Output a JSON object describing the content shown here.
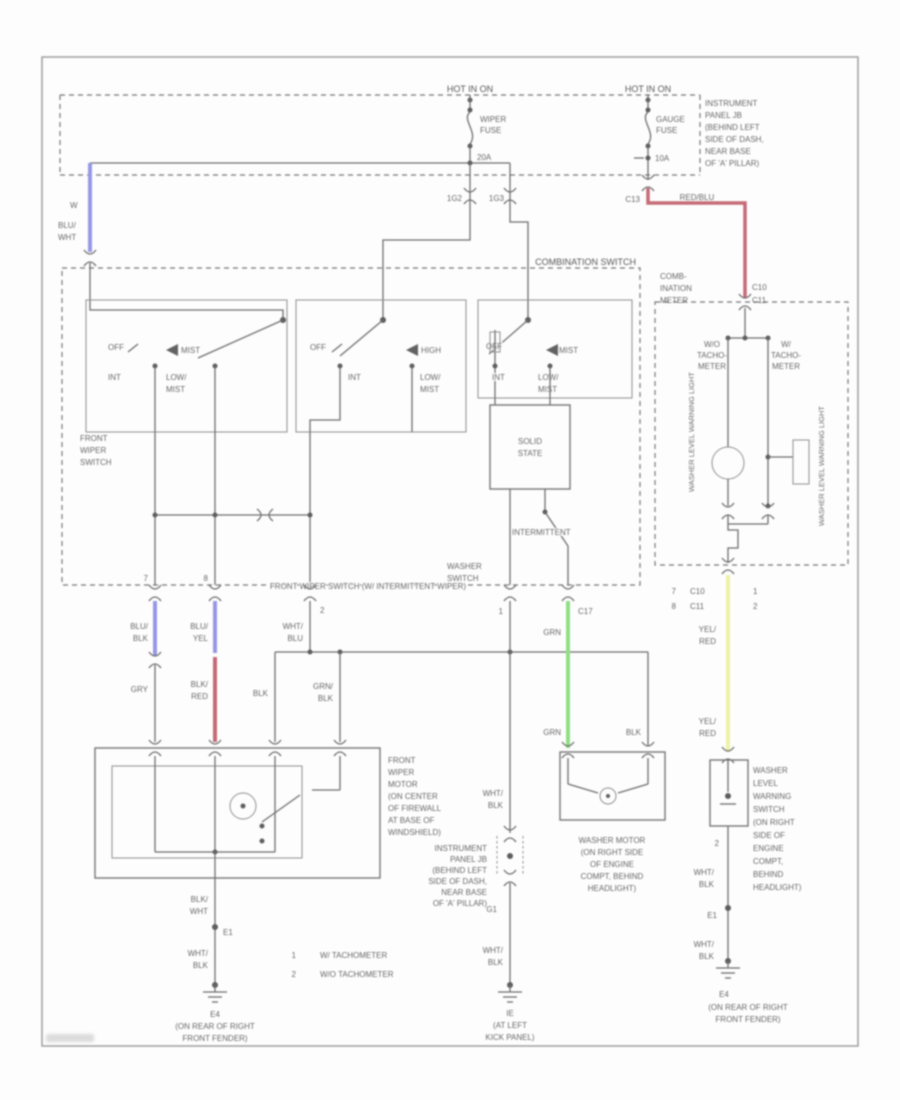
{
  "power": {
    "hot_left": "HOT IN ON",
    "hot_right": "HOT IN ON",
    "wiper_fuse_1": "WIPER",
    "wiper_fuse_2": "FUSE",
    "wiper_fuse_amps": "20A",
    "gauge_fuse_1": "GAUGE",
    "gauge_fuse_2": "FUSE",
    "gauge_fuse_amps": "10A",
    "conn_left_a": "1G2",
    "conn_left_b": "1G3",
    "conn_right": "C13",
    "red_wire_label": "RED/BLU",
    "jb_label": [
      "INSTRUMENT",
      "PANEL JB",
      "(BEHIND LEFT",
      "SIDE OF DASH,",
      "NEAR BASE",
      "OF 'A' PILLAR)"
    ]
  },
  "comb_switch": {
    "title": "COMBINATION SWITCH",
    "switch_name": [
      "FRONT",
      "WIPER",
      "SWITCH"
    ],
    "bottom_label": "FRONT WIPER SWITCH (W/ INTERMITTENT WIPER)",
    "solid_state": [
      "SOLID",
      "STATE"
    ],
    "intermittent": "INTERMITTENT",
    "washer_switch": [
      "WASHER",
      "SWITCH"
    ],
    "bank1": {
      "off": "OFF",
      "momentary": "MIST",
      "int": "INT",
      "low_1": "LOW/",
      "low_2": "MIST"
    },
    "bank2": {
      "off": "OFF",
      "momentary": "HIGH",
      "int": "INT",
      "low_1": "LOW/",
      "low_2": "MIST"
    },
    "bank3": {
      "off": "OFF",
      "momentary": "MIST",
      "int": "INT",
      "low_1": "LOW/",
      "low_2": "MIST"
    },
    "pins": {
      "p1": "7",
      "p2": "8",
      "p3": "2",
      "p4": "1",
      "conn_washer": "C17"
    }
  },
  "wires": {
    "w_mark": "W",
    "blu_wht": [
      "BLU/",
      "WHT"
    ],
    "blu_blk": [
      "BLU/",
      "BLK"
    ],
    "blu_yel": [
      "BLU/",
      "YEL"
    ],
    "gry": "GRY",
    "blk_red": [
      "BLK/",
      "RED"
    ],
    "blk": "BLK",
    "grn_blk": [
      "GRN/",
      "BLK"
    ],
    "wht_blu": [
      "WHT/",
      "BLU"
    ],
    "wht_blk_a": [
      "WHT/",
      "BLK"
    ],
    "wht_blk_b": [
      "WHT/",
      "BLK"
    ],
    "grn_a": "GRN",
    "grn_b": "GRN",
    "washer_blk": "BLK",
    "blk_wht": [
      "BLK/",
      "WHT"
    ],
    "wht_blk_left": [
      "WHT/",
      "BLK"
    ],
    "yel_red_a": [
      "YEL/",
      "RED"
    ],
    "yel_red_b": [
      "YEL/",
      "RED"
    ],
    "wht_blk_r1": [
      "WHT/",
      "BLK"
    ],
    "wht_blk_r2": [
      "WHT/",
      "BLK"
    ]
  },
  "meter": {
    "title": [
      "COMB-",
      "INATION",
      "METER"
    ],
    "conn_top": [
      "C10",
      "C11"
    ],
    "wo_tach": [
      "W/O",
      "TACHO-",
      "METER"
    ],
    "w_tach": [
      "W/",
      "TACHO-",
      "METER"
    ],
    "rotated_left": "WASHER LEVEL WARNING LIGHT",
    "rotated_right": "WASHER LEVEL WARNING LIGHT",
    "rows": [
      {
        "pin": "7",
        "conn": "C10",
        "note": "1"
      },
      {
        "pin": "8",
        "conn": "C11",
        "note": "2"
      }
    ]
  },
  "components": {
    "front_wiper_motor": [
      "FRONT",
      "WIPER",
      "MOTOR",
      "(ON CENTER",
      "OF FIREWALL",
      "AT BASE OF",
      "WINDSHIELD)"
    ],
    "washer_motor": [
      "WASHER MOTOR",
      "(ON RIGHT SIDE",
      "OF ENGINE",
      "COMPT, BEHIND",
      "HEADLIGHT)"
    ],
    "washer_level_switch": [
      "WASHER",
      "LEVEL",
      "WARNING",
      "SWITCH",
      "(ON RIGHT",
      "SIDE OF",
      "ENGINE",
      "COMPT,",
      "BEHIND",
      "HEADLIGHT)"
    ],
    "wls_pin": "2"
  },
  "jb_mid": {
    "label": [
      "INSTRUMENT",
      "PANEL JB",
      "(BEHIND LEFT",
      "SIDE OF DASH,",
      "NEAR BASE",
      "OF 'A' PILLAR)"
    ],
    "ref": "G1"
  },
  "grounds": {
    "left": {
      "splice": "E1",
      "name": "E4",
      "loc_1": "(ON REAR OF RIGHT",
      "loc_2": "FRONT FENDER)"
    },
    "mid": {
      "name": "IE",
      "loc_1": "(AT LEFT",
      "loc_2": "KICK PANEL)"
    },
    "right": {
      "splice": "E1",
      "name": "E4",
      "loc_1": "(ON REAR OF RIGHT",
      "loc_2": "FRONT FENDER)"
    }
  },
  "footnotes": [
    {
      "num": "1",
      "text": "W/ TACHOMETER"
    },
    {
      "num": "2",
      "text": "W/O TACHOMETER"
    }
  ],
  "colors": {
    "blue": "#9191e6",
    "red": "#c2636e",
    "green": "#8adf7e",
    "yellow": "#eef2a2"
  }
}
